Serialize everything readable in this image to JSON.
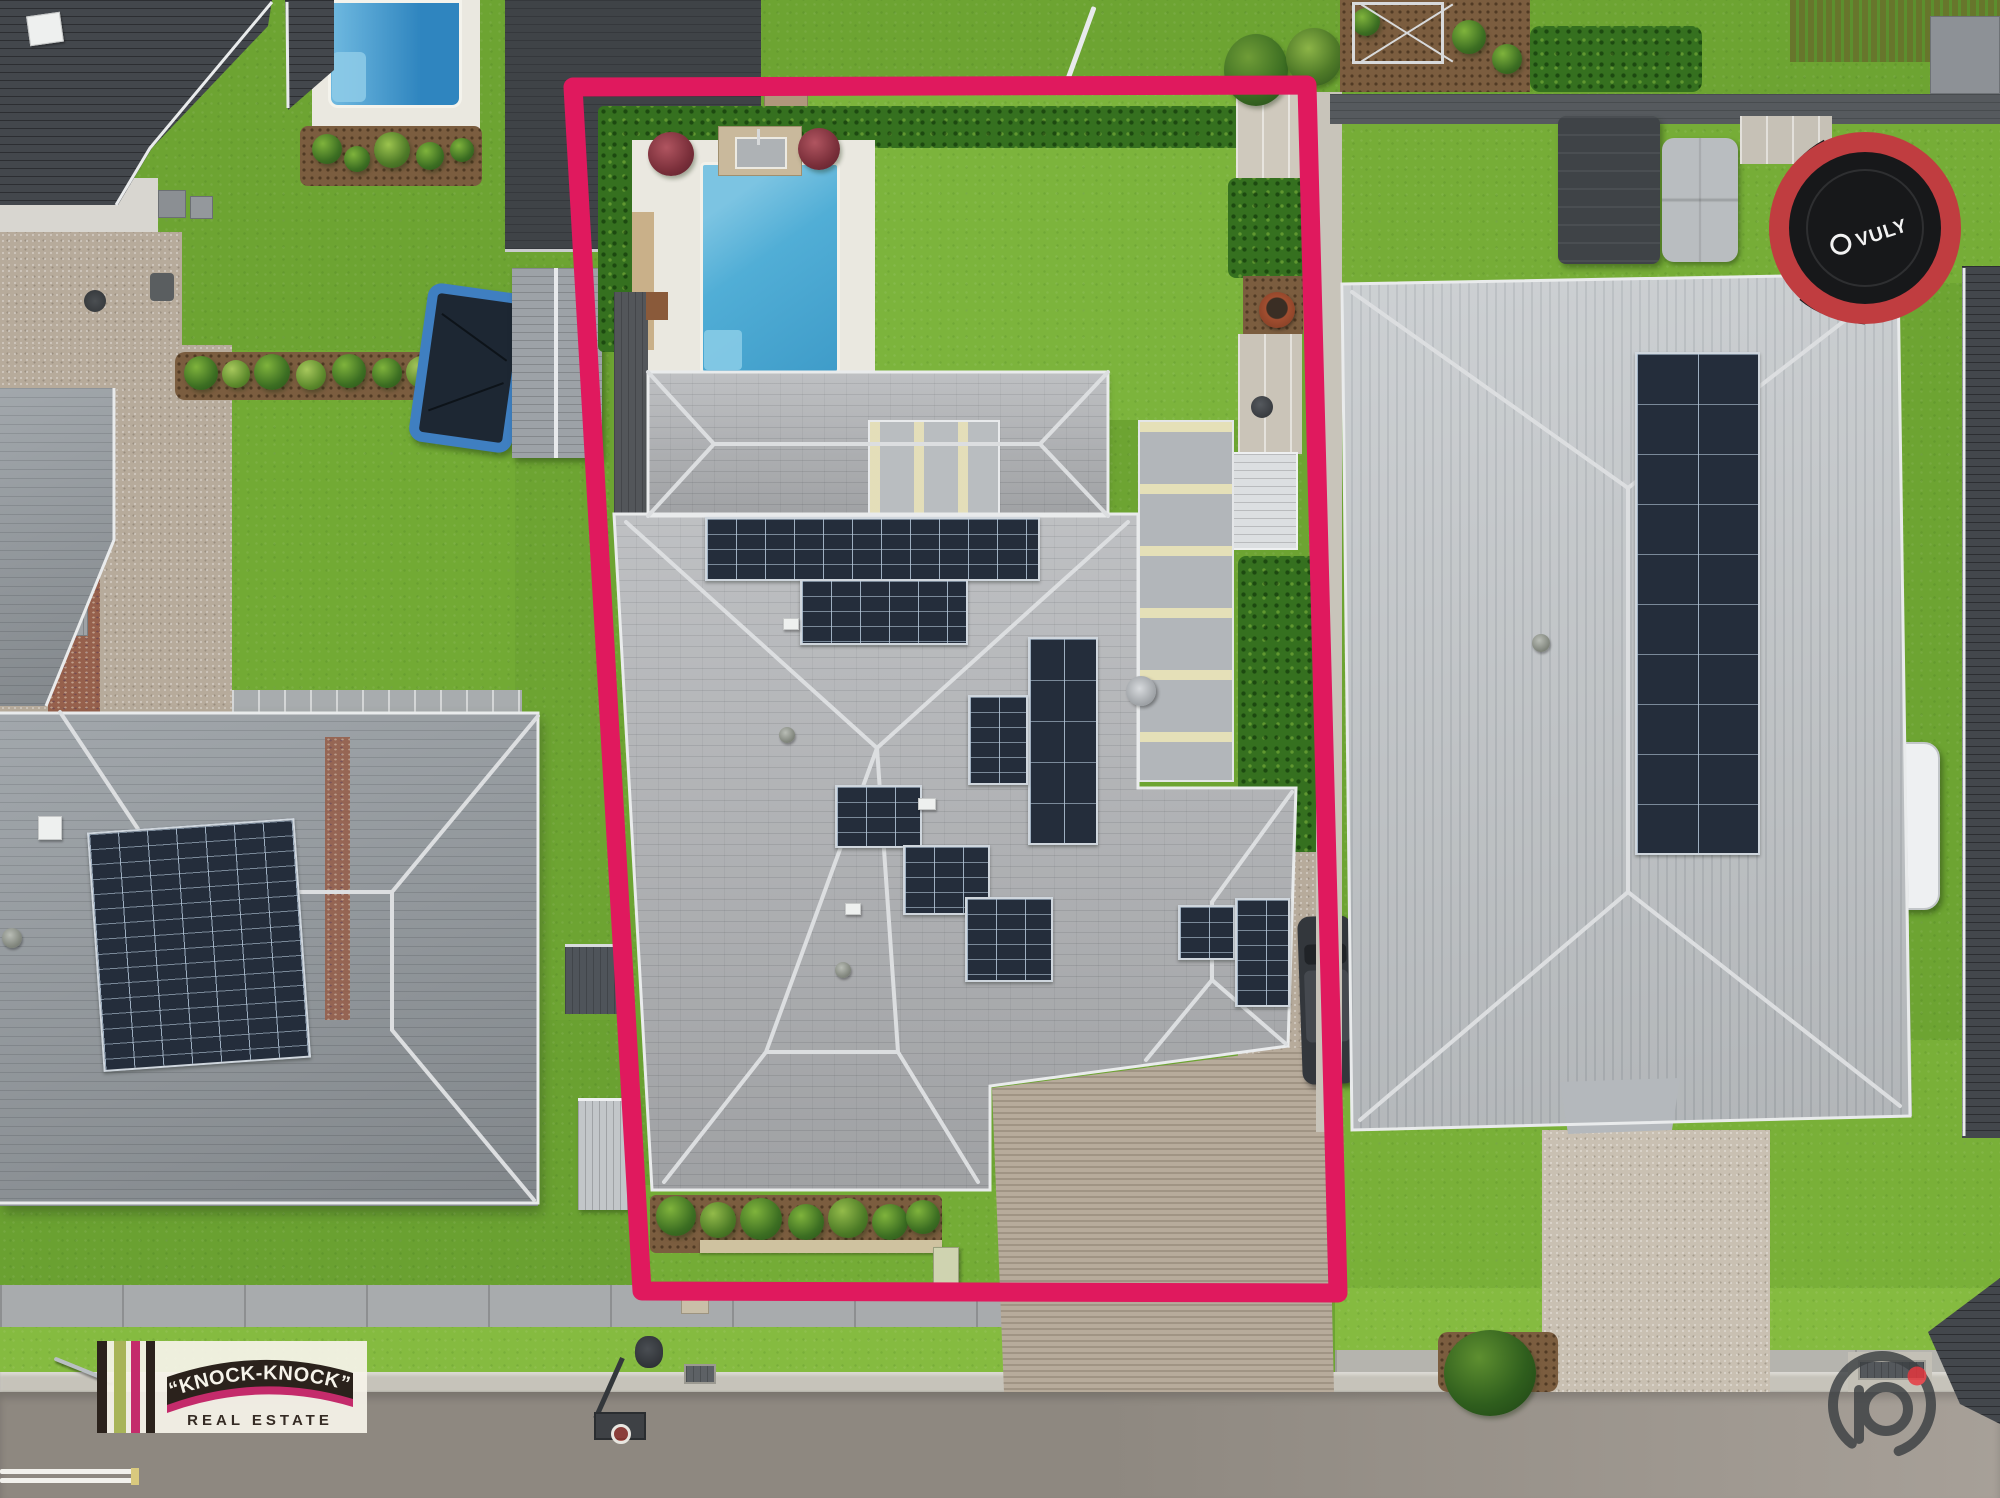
{
  "branding": {
    "arc_text": "“KNOCK-KNOCK”",
    "sub_text": "REAL ESTATE"
  },
  "watermark": {
    "symbol": "p"
  },
  "equipment": {
    "trampoline_brand": "VULY"
  },
  "boundary": {
    "points": "573,87 1307,85 1338,1293 642,1291",
    "stroke_width": "19",
    "color": "#e0195e"
  },
  "theme": {
    "colors": {
      "boundary": "#e0195e",
      "grass": "#6da432",
      "grassBright": "#7cb43c",
      "grassVerge": "#85bb40",
      "roofCenter": "#b7b9bc",
      "roofLeft": "#9aa0a5",
      "roofRight": "#c6cacd",
      "roofDark": "#43474c",
      "solar": "#242d3b",
      "poolWater": "#51aed6",
      "poolDeep": "#2f85bf",
      "deck": "#eae8e0",
      "hedge": "#35701f",
      "aggregate": "#b7ab9b",
      "road": "#8e8880",
      "roadRight": "#a7a098",
      "footpath": "#a8abad",
      "curb": "#c6c3ba",
      "logoCream": "#f6f3ea",
      "logoDark": "#2b221c",
      "logoOlive": "#a8b458",
      "logoMagenta": "#c42b6b",
      "watermarkGray": "#3c4043",
      "watermarkRed": "#e8353d",
      "trampolineRed": "#c03d40"
    }
  }
}
